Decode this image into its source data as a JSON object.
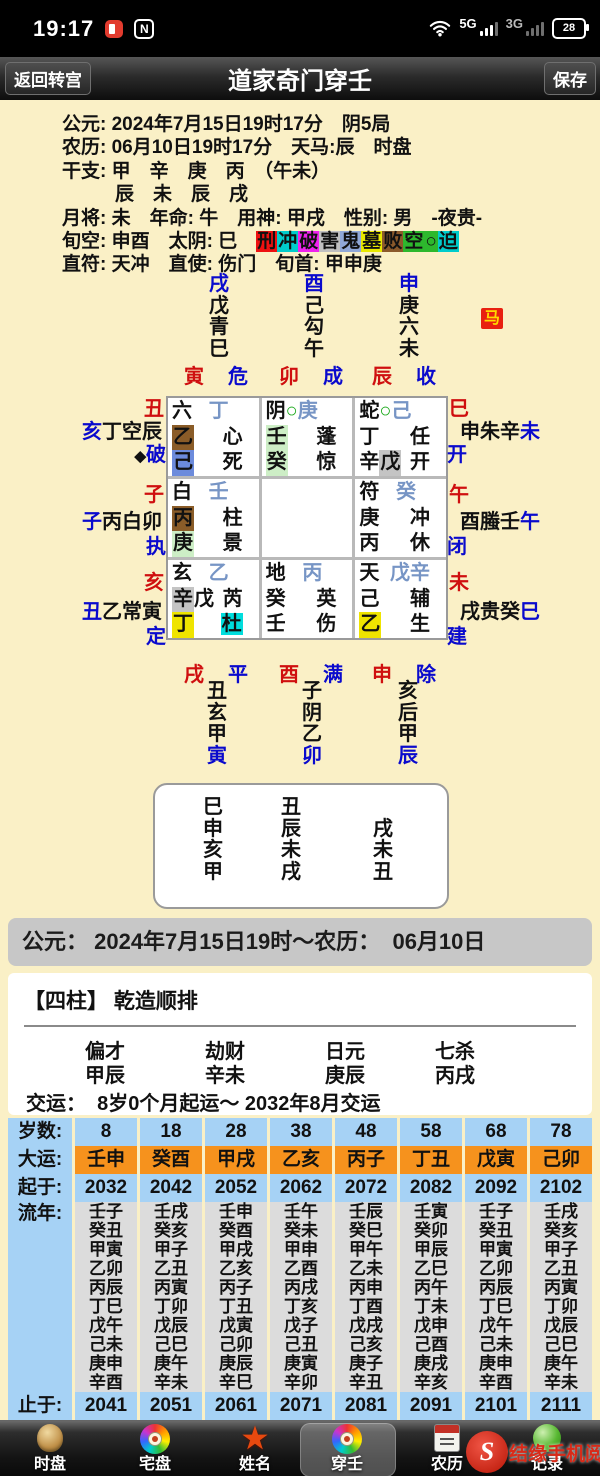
{
  "colors": {
    "background": "#faf0c6",
    "accent_blue": "#0a0acd",
    "accent_red": "#cf0f0f",
    "table_blue": "#a6d2f5",
    "table_orange": "#f6921d",
    "table_gray": "#dcdcdc",
    "token_bg": {
      "brown": "#8a5c28",
      "blue": "#6c8bdc",
      "lgreen": "#cdeec6",
      "silver": "#c4c4c4",
      "yellow": "#efe400",
      "cyan": "#00dddd"
    },
    "token_fg": {
      "slate": "#7795c5",
      "green": "#18a818",
      "blue": "#0a0acd",
      "red": "#cf0f0f",
      "black": "#111111"
    }
  },
  "status_bar": {
    "time": "19:17",
    "nfc": "N",
    "net_5g": "5G",
    "net_3g": "3G",
    "battery": "28"
  },
  "title_bar": {
    "back": "返回转宫",
    "title": "道家奇门穿壬",
    "save": "保存"
  },
  "info": {
    "lines": [
      {
        "text": "公元: 2024年7月15日19时17分　阴5局"
      },
      {
        "text": "农历: 06月10日19时17分　天马:辰　时盘"
      },
      {
        "text": "干支: 甲　辛　庚　丙　（午未）"
      },
      {
        "text": "辰　未　辰　戌",
        "indent": true
      },
      {
        "text": "月将: 未　年命: 牛　用神: 甲戌　性别: 男　-夜贵-"
      }
    ],
    "badge_prefix": "旬空: 申酉　太阴: 巳　",
    "badges": [
      {
        "ch": "刑",
        "bg": "#ee1111"
      },
      {
        "ch": "冲",
        "bg": "#00cccc"
      },
      {
        "ch": "破",
        "bg": "#ee22ee"
      },
      {
        "ch": "害",
        "bg": "#c0c0c0"
      },
      {
        "ch": "鬼",
        "bg": "#90a8d8"
      },
      {
        "ch": "墓",
        "bg": "#e8e800"
      },
      {
        "ch": "败",
        "bg": "#8b5a2b"
      },
      {
        "ch": "空",
        "bg": "#2db82d"
      },
      {
        "ch": "○",
        "bg": "#2db82d"
      },
      {
        "ch": "迫",
        "bg": "#00cccc"
      }
    ],
    "line_after": "直符: 天冲　直使: 伤门　旬首: 甲申庚"
  },
  "upper_ring": {
    "columns": [
      {
        "branch": "戌",
        "cells": [
          "戊",
          "青",
          "巳"
        ]
      },
      {
        "branch": "酉",
        "cells": [
          "己",
          "勾",
          "午"
        ]
      },
      {
        "branch": "申",
        "cells": [
          "庚",
          "六",
          "未"
        ]
      }
    ],
    "ma_badge": "马",
    "jianchu": [
      {
        "branch": "寅",
        "star": "危"
      },
      {
        "branch": "卯",
        "star": "成"
      },
      {
        "branch": "辰",
        "star": "收"
      }
    ]
  },
  "palace_grid": {
    "left_reds": [
      "丑",
      "子",
      "亥"
    ],
    "right_reds": [
      "巳",
      "午",
      "未"
    ],
    "left_labels": [
      {
        "main": [
          [
            "亥",
            "blue"
          ],
          [
            "丁空辰",
            "black"
          ]
        ],
        "sub": [
          [
            "◆",
            "diamond"
          ],
          [
            "破",
            "blue"
          ]
        ]
      },
      {
        "main": [
          [
            "子",
            "blue"
          ],
          [
            "丙白卯",
            "black"
          ]
        ],
        "sub": [
          [
            "执",
            "blue"
          ]
        ]
      },
      {
        "main": [
          [
            "丑",
            "blue"
          ],
          [
            "乙常寅",
            "black"
          ]
        ],
        "sub": [
          [
            "定",
            "blue"
          ]
        ]
      }
    ],
    "right_labels": [
      {
        "main": [
          [
            "申朱辛",
            "black"
          ],
          [
            "未",
            "blue"
          ]
        ],
        "sub": [
          [
            "开",
            "blue"
          ]
        ]
      },
      {
        "main": [
          [
            "酉螣壬",
            "black"
          ],
          [
            "午",
            "blue"
          ]
        ],
        "sub": [
          [
            "闭",
            "blue"
          ]
        ]
      },
      {
        "main": [
          [
            "戌贵癸",
            "black"
          ],
          [
            "巳",
            "blue"
          ]
        ],
        "sub": [
          [
            "建",
            "blue"
          ]
        ]
      }
    ],
    "cells": [
      {
        "rows": [
          {
            "left": [
              {
                "t": "六"
              }
            ],
            "right": [
              {
                "t": "丁",
                "fg": "slate"
              }
            ]
          },
          {
            "left": [
              {
                "t": "乙",
                "bg": "brown"
              }
            ],
            "right": [
              {
                "t": "心"
              }
            ]
          },
          {
            "left": [
              {
                "t": "己",
                "bg": "blue"
              }
            ],
            "right": [
              {
                "t": "死"
              }
            ]
          }
        ]
      },
      {
        "rows": [
          {
            "left": [
              {
                "t": "阴"
              },
              {
                "t": "○",
                "fg": "green"
              },
              {
                "t": "庚",
                "fg": "slate"
              }
            ],
            "right": []
          },
          {
            "left": [
              {
                "t": "壬",
                "bg": "lgreen"
              }
            ],
            "right": [
              {
                "t": "蓬"
              }
            ]
          },
          {
            "left": [
              {
                "t": "癸",
                "bg": "lgreen"
              }
            ],
            "right": [
              {
                "t": "惊"
              }
            ]
          }
        ]
      },
      {
        "rows": [
          {
            "left": [
              {
                "t": "蛇"
              },
              {
                "t": "○",
                "fg": "green"
              },
              {
                "t": "己",
                "fg": "slate"
              }
            ],
            "right": []
          },
          {
            "left": [
              {
                "t": "丁"
              }
            ],
            "right": [
              {
                "t": "任"
              }
            ]
          },
          {
            "left": [
              {
                "t": "辛"
              },
              {
                "t": "戊",
                "bg": "silver"
              }
            ],
            "right": [
              {
                "t": "开"
              }
            ]
          }
        ]
      },
      {
        "rows": [
          {
            "left": [
              {
                "t": "白"
              }
            ],
            "right": [
              {
                "t": "壬",
                "fg": "slate"
              }
            ]
          },
          {
            "left": [
              {
                "t": "丙",
                "bg": "brown"
              }
            ],
            "right": [
              {
                "t": "柱"
              }
            ]
          },
          {
            "left": [
              {
                "t": "庚",
                "bg": "lgreen"
              }
            ],
            "right": [
              {
                "t": "景"
              }
            ]
          }
        ]
      },
      {
        "rows": []
      },
      {
        "rows": [
          {
            "left": [
              {
                "t": "符"
              }
            ],
            "right": [
              {
                "t": "癸",
                "fg": "slate"
              }
            ]
          },
          {
            "left": [
              {
                "t": "庚"
              }
            ],
            "right": [
              {
                "t": "冲"
              }
            ]
          },
          {
            "left": [
              {
                "t": "丙"
              }
            ],
            "right": [
              {
                "t": "休"
              }
            ]
          }
        ]
      },
      {
        "rows": [
          {
            "left": [
              {
                "t": "玄"
              }
            ],
            "right": [
              {
                "t": "乙",
                "fg": "slate"
              }
            ]
          },
          {
            "left": [
              {
                "t": "辛",
                "bg": "silver"
              },
              {
                "t": "戊"
              }
            ],
            "right": [
              {
                "t": "芮"
              }
            ]
          },
          {
            "left": [
              {
                "t": "丁",
                "bg": "yellow"
              }
            ],
            "right": [
              {
                "t": "杜",
                "bg": "cyan"
              }
            ]
          }
        ]
      },
      {
        "rows": [
          {
            "left": [
              {
                "t": "地"
              }
            ],
            "right": [
              {
                "t": "丙",
                "fg": "slate"
              }
            ]
          },
          {
            "left": [
              {
                "t": "癸"
              }
            ],
            "right": [
              {
                "t": "英"
              }
            ]
          },
          {
            "left": [
              {
                "t": "壬"
              }
            ],
            "right": [
              {
                "t": "伤"
              }
            ]
          }
        ]
      },
      {
        "rows": [
          {
            "left": [
              {
                "t": "天"
              }
            ],
            "right": [
              {
                "t": "戊辛",
                "fg": "slate"
              }
            ]
          },
          {
            "left": [
              {
                "t": "己"
              }
            ],
            "right": [
              {
                "t": "辅"
              }
            ]
          },
          {
            "left": [
              {
                "t": "乙",
                "bg": "yellow"
              }
            ],
            "right": [
              {
                "t": "生"
              }
            ]
          }
        ]
      }
    ]
  },
  "lower_ring": {
    "jianchu": [
      {
        "branch": "戌",
        "star": "平"
      },
      {
        "branch": "酉",
        "star": "满"
      },
      {
        "branch": "申",
        "star": "除"
      }
    ],
    "columns": [
      {
        "cells": [
          "丑",
          "玄",
          "甲"
        ],
        "branch": "寅"
      },
      {
        "cells": [
          "子",
          "阴",
          "乙"
        ],
        "branch": "卯"
      },
      {
        "cells": [
          "亥",
          "后",
          "甲"
        ],
        "branch": "辰"
      }
    ]
  },
  "branch_box": {
    "columns": [
      [
        "巳",
        "申",
        "亥",
        "甲"
      ],
      [
        "丑",
        "辰",
        "未",
        "戌"
      ],
      [
        "",
        "戌",
        "未",
        "丑"
      ]
    ]
  },
  "date_bar": "公元： 2024年7月15日19时～农历：  06月10日",
  "sizhu": {
    "title": "【四柱】 乾造顺排",
    "columns": [
      {
        "god": "偏才",
        "pillar": "甲辰"
      },
      {
        "god": "劫财",
        "pillar": "辛未"
      },
      {
        "god": "日元",
        "pillar": "庚辰"
      },
      {
        "god": "七杀",
        "pillar": "丙戌"
      }
    ],
    "jiaoyun": "交运：  8岁0个月起运～ 2032年8月交运"
  },
  "dayun_table": {
    "row_labels": [
      "岁数:",
      "大运:",
      "起于:",
      "流年:",
      "止于:"
    ],
    "columns": [
      {
        "age": "8",
        "dayun": "壬申",
        "start": "2032",
        "liunian": [
          "壬子",
          "癸丑",
          "甲寅",
          "乙卯",
          "丙辰",
          "丁巳",
          "戊午",
          "己未",
          "庚申",
          "辛酉"
        ],
        "end": "2041"
      },
      {
        "age": "18",
        "dayun": "癸酉",
        "start": "2042",
        "liunian": [
          "壬戌",
          "癸亥",
          "甲子",
          "乙丑",
          "丙寅",
          "丁卯",
          "戊辰",
          "己巳",
          "庚午",
          "辛未"
        ],
        "end": "2051"
      },
      {
        "age": "28",
        "dayun": "甲戌",
        "start": "2052",
        "liunian": [
          "壬申",
          "癸酉",
          "甲戌",
          "乙亥",
          "丙子",
          "丁丑",
          "戊寅",
          "己卯",
          "庚辰",
          "辛巳"
        ],
        "end": "2061"
      },
      {
        "age": "38",
        "dayun": "乙亥",
        "start": "2062",
        "liunian": [
          "壬午",
          "癸未",
          "甲申",
          "乙酉",
          "丙戌",
          "丁亥",
          "戊子",
          "己丑",
          "庚寅",
          "辛卯"
        ],
        "end": "2071"
      },
      {
        "age": "48",
        "dayun": "丙子",
        "start": "2072",
        "liunian": [
          "壬辰",
          "癸巳",
          "甲午",
          "乙未",
          "丙申",
          "丁酉",
          "戊戌",
          "己亥",
          "庚子",
          "辛丑"
        ],
        "end": "2081"
      },
      {
        "age": "58",
        "dayun": "丁丑",
        "start": "2082",
        "liunian": [
          "壬寅",
          "癸卯",
          "甲辰",
          "乙巳",
          "丙午",
          "丁未",
          "戊申",
          "己酉",
          "庚戌",
          "辛亥"
        ],
        "end": "2091"
      },
      {
        "age": "68",
        "dayun": "戊寅",
        "start": "2092",
        "liunian": [
          "壬子",
          "癸丑",
          "甲寅",
          "乙卯",
          "丙辰",
          "丁巳",
          "戊午",
          "己未",
          "庚申",
          "辛酉"
        ],
        "end": "2101"
      },
      {
        "age": "78",
        "dayun": "己卯",
        "start": "2102",
        "liunian": [
          "壬戌",
          "癸亥",
          "甲子",
          "乙丑",
          "丙寅",
          "丁卯",
          "戊辰",
          "己巳",
          "庚午",
          "辛未"
        ],
        "end": "2111"
      }
    ]
  },
  "nav": {
    "items": [
      {
        "label": "时盘",
        "icon": "shipan-dial-icon",
        "cls": "icon-shipan"
      },
      {
        "label": "宅盘",
        "icon": "luopan-compass-icon",
        "cls": "icon-luopan"
      },
      {
        "label": "姓名",
        "icon": "star-icon",
        "cls": "icon-star",
        "glyph": "★"
      },
      {
        "label": "穿壬",
        "icon": "luopan-compass-icon",
        "cls": "icon-luopan",
        "selected": true
      },
      {
        "label": "农历",
        "icon": "calendar-icon",
        "cls": "icon-calendar"
      },
      {
        "label": "记录",
        "icon": "record-orb-icon",
        "cls": "icon-orb"
      }
    ]
  },
  "watermark": {
    "logo": "S",
    "text": "结缘手机阅"
  }
}
